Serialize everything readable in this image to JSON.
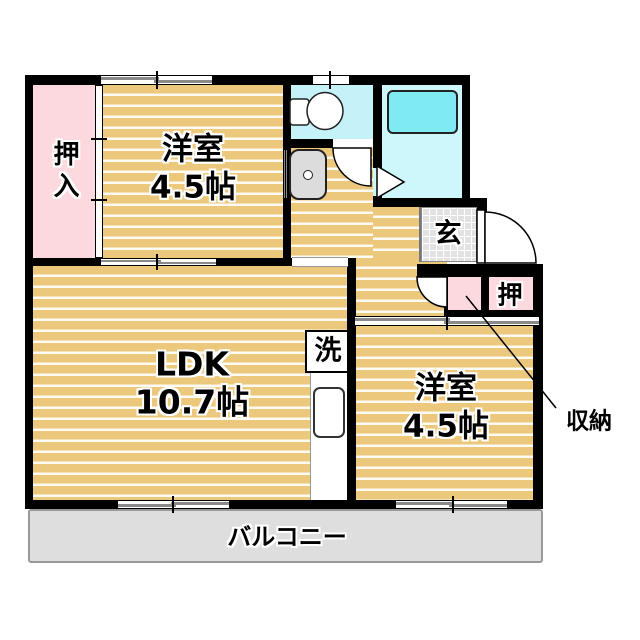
{
  "title": "apartment-floorplan",
  "labels": {
    "closet_top_left": "押入",
    "bedroom_top_name": "洋室",
    "bedroom_top_size": "4.5帖",
    "ldk_name": "LDK",
    "ldk_size": "10.7帖",
    "bedroom_right_name": "洋室",
    "bedroom_right_size": "4.5帖",
    "entrance": "玄",
    "closet_right": "押",
    "laundry": "洗",
    "storage": "収納",
    "balcony": "バルコニー"
  },
  "colors": {
    "tan": "#EBC87C",
    "stripe": "#FCFAF2",
    "pink": "#FBD9DE",
    "toiletFloor": "#C4F2F8",
    "bathFloor": "#CDF7FA",
    "tub": "#80EAF2",
    "genkan": "#E2E2E2",
    "balcony": "#DEDEDE",
    "wall": "#000000"
  },
  "fixtures": [
    "toilet",
    "bathtub",
    "washbasin",
    "washing-machine"
  ],
  "openings": [
    "sliding-window-top",
    "toilet-window",
    "balcony-window-ldk",
    "balcony-window-bedroom",
    "fusuma-closet-top-left",
    "fusuma-bedroom-ldk",
    "sliding-door-bedroom-right",
    "hinged-door-toilet",
    "hinged-door-storage",
    "front-door",
    "bath-door"
  ]
}
